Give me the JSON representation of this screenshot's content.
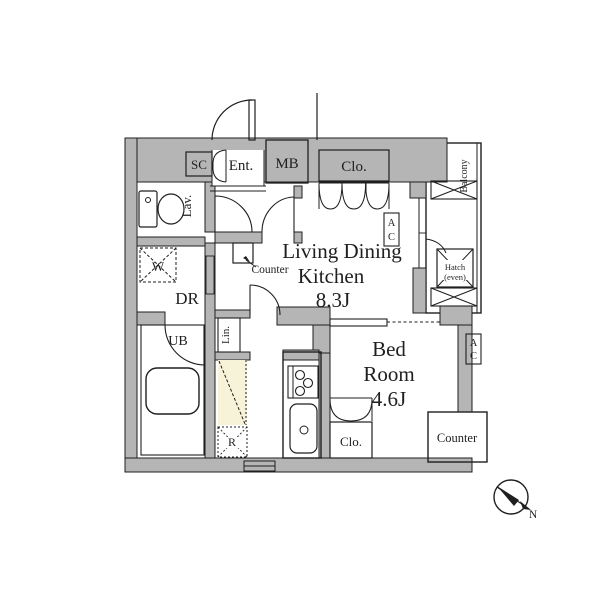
{
  "colors": {
    "wall_fill": "#b5b5b5",
    "accent_beige": "#f7f3d8",
    "line": "#1f1f1f",
    "background": "#ffffff"
  },
  "labels": {
    "shoe_closet": "SC",
    "entrance": "Ent.",
    "meter_box": "MB",
    "closet_entry": "Clo.",
    "lavatory": "Lav.",
    "washing_machine": "W",
    "dressing_room": "DR",
    "unit_bath": "UB",
    "linen": "Lin.",
    "refrigerator": "R",
    "hall_counter": "Counter",
    "ac_letter_top": "A",
    "ac_letter_bottom": "C",
    "ldk_line1": "Living Dining",
    "ldk_line2": "Kitchen",
    "ldk_area": "8.3J",
    "bedroom_line1": "Bed",
    "bedroom_line2": "Room",
    "bedroom_area": "4.6J",
    "closet_bedroom": "Clo.",
    "bedroom_counter": "Counter",
    "balcony": "Balcony",
    "hatch_line1": "Hatch",
    "hatch_line2": "(even)",
    "compass_north": "N"
  }
}
